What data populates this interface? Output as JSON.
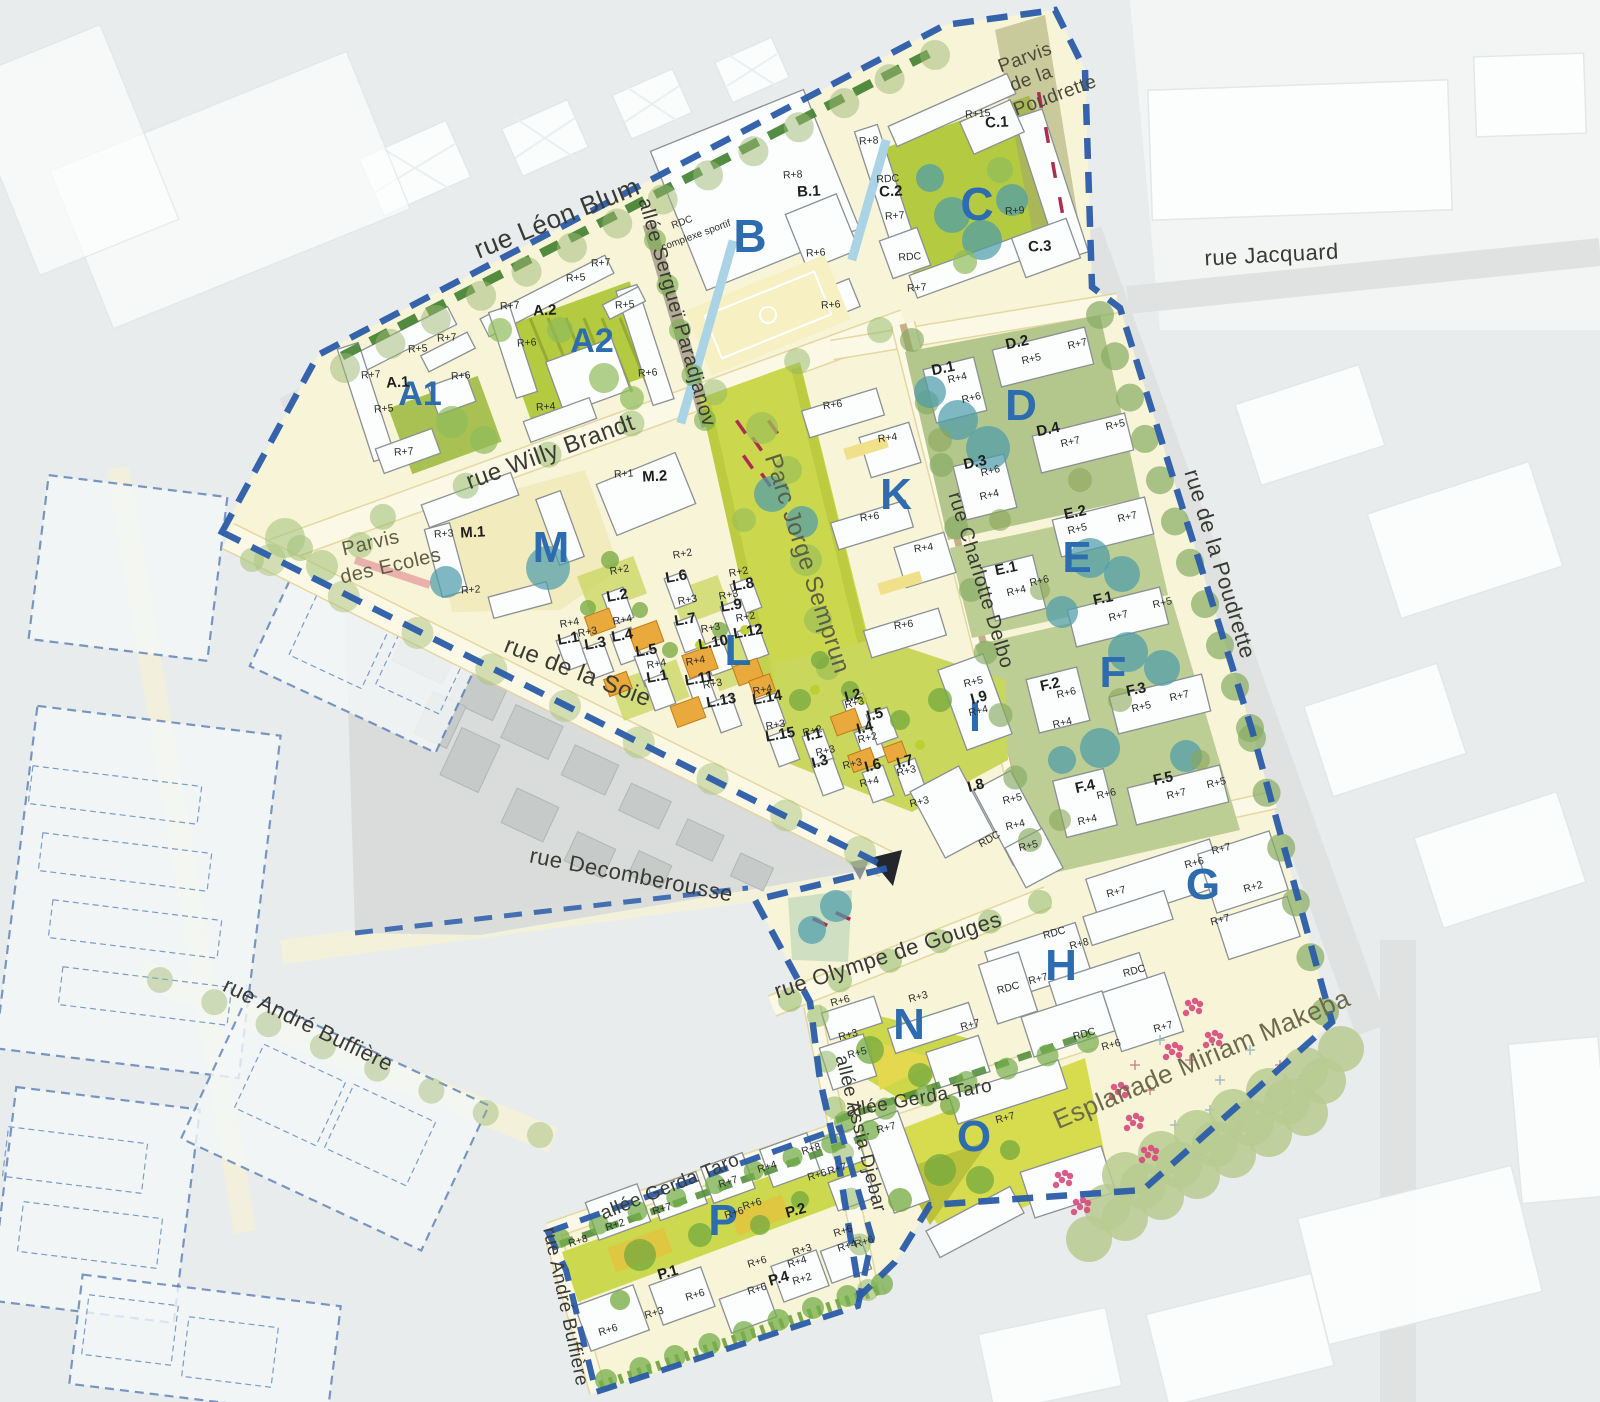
{
  "map": {
    "colors": {
      "background": "#e9ecec",
      "site_fill": "#f8f4d8",
      "street_fill": "#fbf8e6",
      "park_green": "#cbd84d",
      "block_ground_green": "#bcce94",
      "building_white": "#fcfdfd",
      "building_orange": "#e9a93c",
      "boundary_blue": "#2a5ca9",
      "block_letter_blue": "#2e6cb0",
      "street_label_dark": "#3a3a35",
      "park_label_olive": "#5e5e45",
      "teal_tree": "#4f9dab",
      "pink_flower": "#d8487c",
      "red_dash": "#ad2d50"
    },
    "street_labels": [
      {
        "t": "rue Léon Blum",
        "x": 560,
        "y": 226,
        "r": -22,
        "s": 26
      },
      {
        "t": "allée Sergueï Paradjanov",
        "x": 671,
        "y": 314,
        "r": 74,
        "s": 20
      },
      {
        "t": "rue Jacquard",
        "x": 1272,
        "y": 262,
        "r": -3,
        "s": 22
      },
      {
        "t": "rue Willy Brandt",
        "x": 553,
        "y": 459,
        "r": -20,
        "s": 24
      },
      {
        "t": "rue Charlotte Delbo",
        "x": 975,
        "y": 582,
        "r": 73,
        "s": 20
      },
      {
        "t": "rue de la Poudrette",
        "x": 1213,
        "y": 566,
        "r": 73,
        "s": 22
      },
      {
        "t": "Parc Jorge Semprun",
        "x": 800,
        "y": 566,
        "r": 72,
        "s": 24,
        "c": "#5e5e45"
      },
      {
        "t": "rue de la Soie",
        "x": 575,
        "y": 679,
        "r": 21,
        "s": 24
      },
      {
        "t": "rue Decomberousse",
        "x": 630,
        "y": 882,
        "r": 11,
        "s": 22
      },
      {
        "t": "rue Olympe de Gouges",
        "x": 890,
        "y": 962,
        "r": -18,
        "s": 22
      },
      {
        "t": "rue André Buffière",
        "x": 305,
        "y": 1031,
        "r": 26,
        "s": 22
      },
      {
        "t": "allée Gerda Taro",
        "x": 920,
        "y": 1104,
        "r": -10,
        "s": 19
      },
      {
        "t": "allée Assia Djebar",
        "x": 855,
        "y": 1135,
        "r": 76,
        "s": 19
      },
      {
        "t": "allée Gerda Taro",
        "x": 672,
        "y": 1192,
        "r": -22,
        "s": 19
      },
      {
        "t": "rue André Buffière",
        "x": 560,
        "y": 1308,
        "r": 78,
        "s": 19
      },
      {
        "t": "Esplanade Miriam Makeba",
        "x": 1205,
        "y": 1067,
        "r": -23,
        "s": 26,
        "c": "#6b6b4c"
      },
      {
        "t": "Parvis",
        "x": 372,
        "y": 549,
        "r": -13,
        "s": 20,
        "c": "#5e5e45"
      },
      {
        "t": "des Ecoles",
        "x": 392,
        "y": 572,
        "r": -13,
        "s": 20,
        "c": "#5e5e45"
      },
      {
        "t": "Parvis",
        "x": 1027,
        "y": 63,
        "r": -20,
        "s": 19,
        "c": "#4a4a3a"
      },
      {
        "t": "de la",
        "x": 1033,
        "y": 84,
        "r": -20,
        "s": 19,
        "c": "#4a4a3a"
      },
      {
        "t": "Poudrette",
        "x": 1057,
        "y": 101,
        "r": -20,
        "s": 19,
        "c": "#4a4a3a"
      }
    ],
    "annotations": [
      {
        "t": "RDC",
        "x": 683,
        "y": 225,
        "r": -20,
        "s": 10
      },
      {
        "t": "complexe sportif",
        "x": 697,
        "y": 238,
        "r": -20,
        "s": 10
      }
    ],
    "block_letters": [
      [
        "A1",
        420,
        405,
        34
      ],
      [
        "A2",
        592,
        352,
        34
      ],
      [
        "B",
        750,
        252,
        46
      ],
      [
        "C",
        977,
        220,
        46
      ],
      [
        "D",
        1021,
        420,
        44
      ],
      [
        "E",
        1077,
        572,
        44
      ],
      [
        "F",
        1113,
        687,
        44
      ],
      [
        "G",
        1203,
        899,
        44
      ],
      [
        "H",
        1061,
        980,
        44
      ],
      [
        "I",
        975,
        731,
        42
      ],
      [
        "K",
        896,
        509,
        44
      ],
      [
        "L",
        738,
        665,
        44
      ],
      [
        "M",
        551,
        562,
        44
      ],
      [
        "N",
        909,
        1039,
        44
      ],
      [
        "O",
        974,
        1151,
        44
      ],
      [
        "P",
        723,
        1235,
        44
      ]
    ],
    "parcel_labels": [
      [
        "A.1",
        398,
        387,
        -3
      ],
      [
        "A.2",
        545,
        315,
        -3
      ],
      [
        "B.1",
        809,
        196,
        -3
      ],
      [
        "C.1",
        997,
        127,
        -3
      ],
      [
        "C.2",
        891,
        196,
        -3
      ],
      [
        "C.3",
        1040,
        251,
        -3
      ],
      [
        "D.1",
        944,
        373,
        -12
      ],
      [
        "D.2",
        1018,
        347,
        -12
      ],
      [
        "D.3",
        976,
        467,
        -12
      ],
      [
        "D.4",
        1049,
        434,
        -12
      ],
      [
        "E.1",
        1007,
        573,
        -12
      ],
      [
        "E.2",
        1076,
        517,
        -12
      ],
      [
        "F.1",
        1104,
        603,
        -12
      ],
      [
        "F.2",
        1051,
        689,
        -12
      ],
      [
        "F.3",
        1137,
        694,
        -12
      ],
      [
        "F.4",
        1086,
        791,
        -12
      ],
      [
        "F.5",
        1164,
        783,
        -12
      ],
      [
        "I.1",
        815,
        739,
        -15
      ],
      [
        "I.2",
        854,
        700,
        -15
      ],
      [
        "I.3",
        821,
        766,
        -15
      ],
      [
        "I.4",
        866,
        732,
        -15
      ],
      [
        "I.5",
        876,
        719,
        -15
      ],
      [
        "I.6",
        874,
        770,
        -15
      ],
      [
        "I.7",
        906,
        766,
        -15
      ],
      [
        "I.8",
        977,
        790,
        -15
      ],
      [
        "I.9",
        980,
        702,
        -15
      ],
      [
        "L.1",
        569,
        643,
        -10
      ],
      [
        "L.2",
        618,
        600,
        -10
      ],
      [
        "L.3",
        596,
        648,
        -10
      ],
      [
        "L.4",
        623,
        640,
        -10
      ],
      [
        "L.5",
        647,
        655,
        -10
      ],
      [
        "L.6",
        677,
        581,
        -10
      ],
      [
        "L.7",
        686,
        624,
        -10
      ],
      [
        "L.8",
        744,
        589,
        -10
      ],
      [
        "L.9",
        732,
        610,
        -10
      ],
      [
        "L.10",
        714,
        647,
        -10
      ],
      [
        "L.11",
        700,
        683,
        -10
      ],
      [
        "L.12",
        749,
        636,
        -10
      ],
      [
        "L.13",
        722,
        705,
        -10
      ],
      [
        "L.14",
        768,
        702,
        -10
      ],
      [
        "L.15",
        781,
        739,
        -10
      ],
      [
        "L.1",
        658,
        681,
        -10
      ],
      [
        "M.1",
        473,
        537,
        -3
      ],
      [
        "M.2",
        655,
        481,
        -3
      ],
      [
        "P.1",
        669,
        1277,
        -16
      ],
      [
        "P.2",
        797,
        1215,
        -16
      ],
      [
        "P.4",
        780,
        1283,
        -16
      ]
    ],
    "height_labels": [
      [
        "R+7",
        601,
        266,
        -4
      ],
      [
        "R+5",
        576,
        281,
        -4
      ],
      [
        "R+7",
        510,
        309,
        -4
      ],
      [
        "R+5",
        625,
        308,
        -4
      ],
      [
        "R+6",
        527,
        346,
        -4
      ],
      [
        "R+6",
        648,
        376,
        -4
      ],
      [
        "R+4",
        546,
        410,
        -4
      ],
      [
        "R+7",
        447,
        341,
        -4
      ],
      [
        "R+5",
        418,
        352,
        -4
      ],
      [
        "R+7",
        371,
        378,
        -4
      ],
      [
        "R+6",
        461,
        379,
        -4
      ],
      [
        "R+5",
        384,
        412,
        -4
      ],
      [
        "R+7",
        404,
        455,
        -4
      ],
      [
        "R+8",
        793,
        178,
        -4
      ],
      [
        "R+6",
        816,
        256,
        -4
      ],
      [
        "R+6",
        831,
        308,
        -4
      ],
      [
        "R+15",
        978,
        117,
        -4
      ],
      [
        "R+8",
        869,
        144,
        -4
      ],
      [
        "RDC",
        888,
        182,
        -4
      ],
      [
        "R+7",
        895,
        219,
        -4
      ],
      [
        "R+9",
        1015,
        214,
        -4
      ],
      [
        "RDC",
        910,
        260,
        -4
      ],
      [
        "R+7",
        917,
        291,
        -4
      ],
      [
        "R+6",
        833,
        408,
        -8
      ],
      [
        "R+4",
        888,
        441,
        -8
      ],
      [
        "R+6",
        870,
        520,
        -8
      ],
      [
        "R+4",
        924,
        551,
        -8
      ],
      [
        "R+6",
        904,
        628,
        -8
      ],
      [
        "R+4",
        958,
        381,
        -13
      ],
      [
        "R+6",
        972,
        401,
        -13
      ],
      [
        "R+5",
        1032,
        362,
        -13
      ],
      [
        "R+7",
        1078,
        347,
        -13
      ],
      [
        "R+6",
        991,
        474,
        -13
      ],
      [
        "R+4",
        990,
        498,
        -13
      ],
      [
        "R+7",
        1071,
        445,
        -13
      ],
      [
        "R+5",
        1116,
        428,
        -13
      ],
      [
        "R+4",
        1017,
        594,
        -13
      ],
      [
        "R+6",
        1040,
        584,
        -13
      ],
      [
        "R+5",
        1078,
        532,
        -13
      ],
      [
        "R+7",
        1128,
        520,
        -13
      ],
      [
        "R+7",
        1119,
        619,
        -13
      ],
      [
        "R+5",
        1163,
        606,
        -13
      ],
      [
        "R+6",
        1067,
        696,
        -13
      ],
      [
        "R+4",
        1063,
        726,
        -13
      ],
      [
        "R+5",
        1142,
        710,
        -13
      ],
      [
        "R+7",
        1180,
        699,
        -13
      ],
      [
        "R+6",
        1107,
        797,
        -13
      ],
      [
        "R+4",
        1088,
        823,
        -13
      ],
      [
        "R+7",
        1177,
        797,
        -13
      ],
      [
        "R+5",
        1217,
        786,
        -13
      ],
      [
        "R+5",
        974,
        685,
        -13
      ],
      [
        "R+4",
        979,
        714,
        -13
      ],
      [
        "R+2",
        813,
        734,
        -13
      ],
      [
        "R+3",
        855,
        706,
        -13
      ],
      [
        "R+2",
        868,
        741,
        -13
      ],
      [
        "R+3",
        826,
        754,
        -13
      ],
      [
        "R+3",
        853,
        767,
        -13
      ],
      [
        "R+4",
        870,
        785,
        -13
      ],
      [
        "R+3",
        907,
        774,
        -13
      ],
      [
        "R+3",
        920,
        805,
        -13
      ],
      [
        "R+5",
        1013,
        802,
        -13
      ],
      [
        "R+4",
        1016,
        828,
        -13
      ],
      [
        "R+5",
        1029,
        849,
        -13
      ],
      [
        "RDC",
        991,
        842,
        -30
      ],
      [
        "R+2",
        620,
        573,
        -10
      ],
      [
        "R+2",
        683,
        557,
        -10
      ],
      [
        "R+2",
        739,
        575,
        -10
      ],
      [
        "R+3",
        688,
        603,
        -10
      ],
      [
        "R+3",
        729,
        598,
        -10
      ],
      [
        "R+2",
        746,
        620,
        -10
      ],
      [
        "R+4",
        623,
        623,
        -10
      ],
      [
        "R+3",
        588,
        635,
        -10
      ],
      [
        "R+4",
        570,
        626,
        -10
      ],
      [
        "R+3",
        711,
        631,
        -10
      ],
      [
        "R+4",
        657,
        667,
        -10
      ],
      [
        "R+4",
        696,
        664,
        -10
      ],
      [
        "R+3",
        713,
        687,
        -10
      ],
      [
        "R+4",
        763,
        693,
        -10
      ],
      [
        "R+3",
        776,
        728,
        -10
      ],
      [
        "R+3",
        444,
        537,
        -4
      ],
      [
        "R+2",
        471,
        593,
        -4
      ],
      [
        "R+1",
        624,
        477,
        -4
      ],
      [
        "R+7",
        1222,
        852,
        -15
      ],
      [
        "R+6",
        1195,
        866,
        -15
      ],
      [
        "R+2",
        1254,
        890,
        -15
      ],
      [
        "R+7",
        1117,
        895,
        -15
      ],
      [
        "R+7",
        1221,
        923,
        -15
      ],
      [
        "RDC",
        1055,
        936,
        -15
      ],
      [
        "R+8",
        1080,
        947,
        -15
      ],
      [
        "R+7",
        1039,
        982,
        -15
      ],
      [
        "RDC",
        1009,
        991,
        -15
      ],
      [
        "RDC",
        1135,
        974,
        -15
      ],
      [
        "RDC",
        1085,
        1037,
        -15
      ],
      [
        "R+6",
        1112,
        1048,
        -15
      ],
      [
        "R+7",
        1164,
        1030,
        -15
      ],
      [
        "R+6",
        841,
        1004,
        -15
      ],
      [
        "R+3",
        849,
        1038,
        -15
      ],
      [
        "R+5",
        858,
        1056,
        -15
      ],
      [
        "R+3",
        919,
        1000,
        -15
      ],
      [
        "R+7",
        971,
        1028,
        -15
      ],
      [
        "R+7",
        1006,
        1121,
        -15
      ],
      [
        "R+7",
        887,
        1131,
        -15
      ],
      [
        "R+8",
        812,
        1152,
        -17
      ],
      [
        "R+6",
        818,
        1178,
        -17
      ],
      [
        "R+7",
        838,
        1172,
        -17
      ],
      [
        "R+4",
        768,
        1170,
        -17
      ],
      [
        "R+7",
        729,
        1185,
        -17
      ],
      [
        "R+6",
        735,
        1216,
        -17
      ],
      [
        "R+6",
        753,
        1207,
        -17
      ],
      [
        "R+6",
        844,
        1234,
        -17
      ],
      [
        "R+4",
        848,
        1249,
        -17
      ],
      [
        "R+6",
        865,
        1245,
        -17
      ],
      [
        "R+7",
        663,
        1212,
        -17
      ],
      [
        "R+2",
        616,
        1228,
        -17
      ],
      [
        "R+8",
        579,
        1244,
        -17
      ],
      [
        "R+6",
        696,
        1298,
        -17
      ],
      [
        "R+3",
        655,
        1316,
        -17
      ],
      [
        "R+6",
        609,
        1333,
        -17
      ],
      [
        "R+6",
        758,
        1265,
        -17
      ],
      [
        "R+6",
        758,
        1292,
        -17
      ],
      [
        "R+3",
        803,
        1253,
        -17
      ],
      [
        "R+4",
        798,
        1265,
        -17
      ],
      [
        "R+2",
        803,
        1282,
        -17
      ]
    ]
  }
}
